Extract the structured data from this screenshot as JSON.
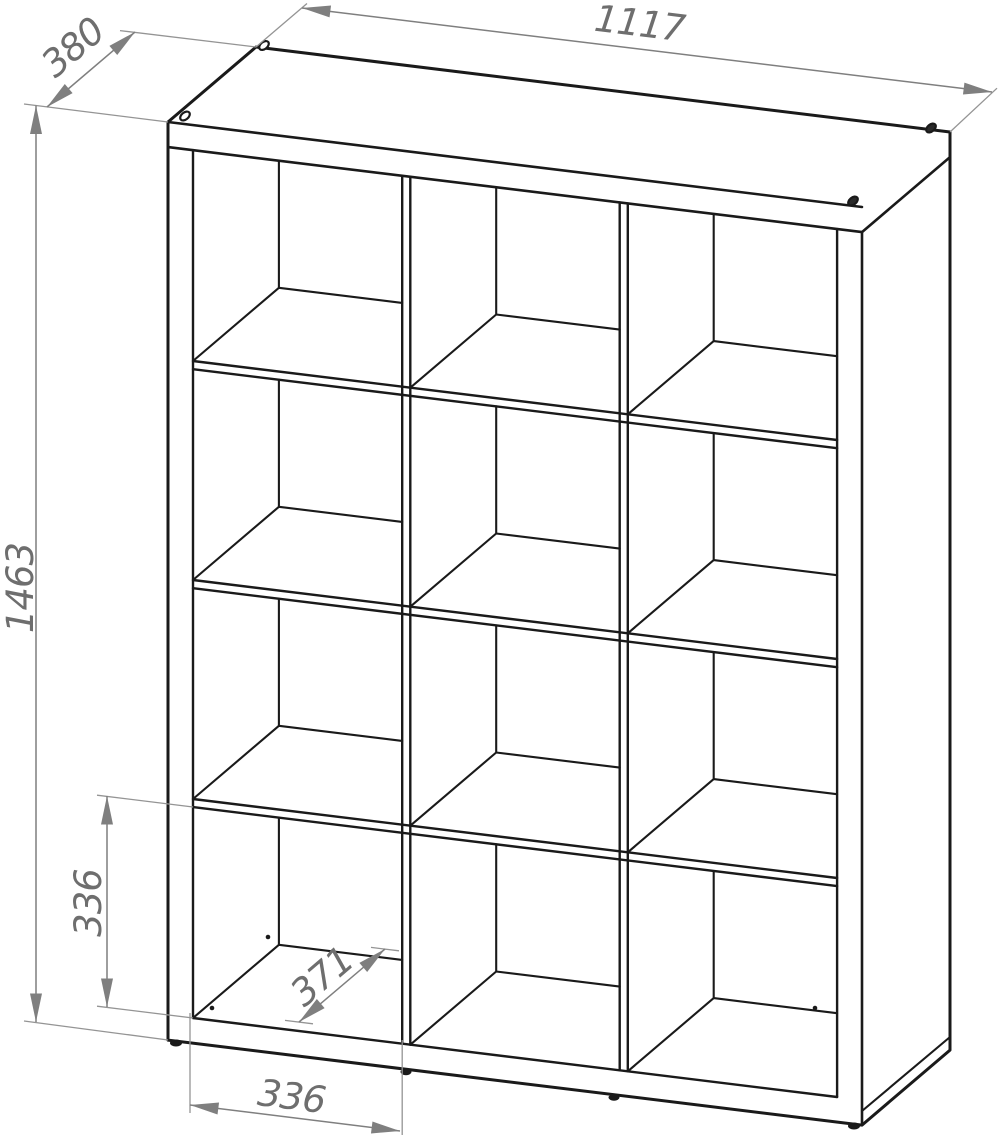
{
  "drawing": {
    "structure": {
      "rows": 4,
      "columns": 3
    },
    "dimensions": {
      "overall_width": "1117",
      "overall_depth": "380",
      "overall_height": "1463",
      "cell_inner_height": "336",
      "cell_inner_depth": "371",
      "cell_inner_width": "336"
    },
    "colors": {
      "outline": "#1a1a1a",
      "dimension_line": "#7f7f7f",
      "dimension_text": "#6e6e6e",
      "background": "#ffffff"
    }
  }
}
